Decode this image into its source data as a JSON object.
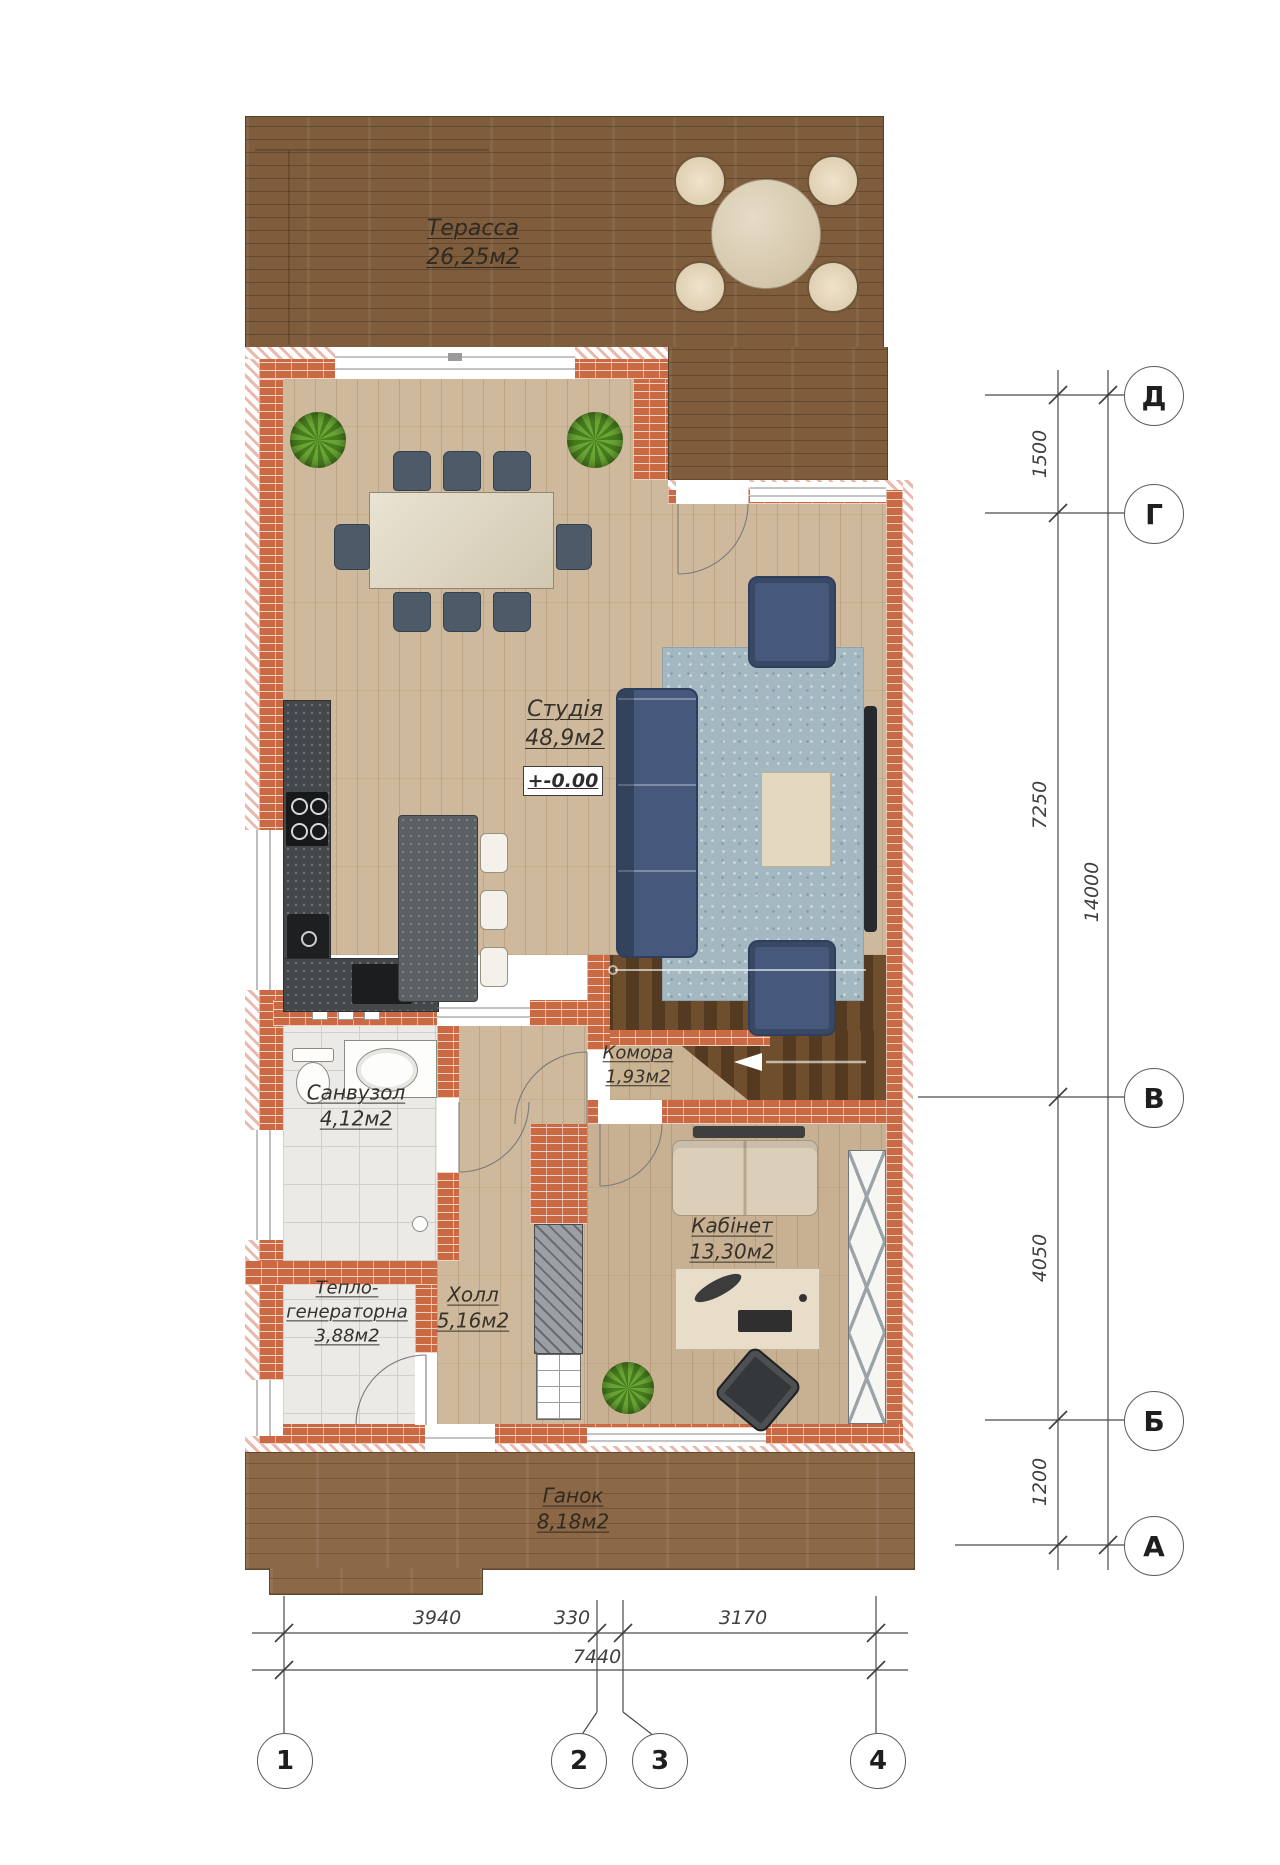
{
  "drawing": {
    "type": "architectural-floor-plan",
    "floor": "first"
  },
  "rooms": {
    "terrace": {
      "name": "Терасса",
      "area": "26,25м2"
    },
    "studio": {
      "name": "Студія",
      "area": "48,9м2"
    },
    "pantry": {
      "name": "Комора",
      "area": "1,93м2"
    },
    "bathroom": {
      "name": "Санвузол",
      "area": "4,12м2"
    },
    "boiler": {
      "name1": "Тепло-",
      "name2": "генераторна",
      "area": "3,88м2"
    },
    "hall": {
      "name": "Холл",
      "area": "5,16м2"
    },
    "office": {
      "name": "Кабінет",
      "area": "13,30м2"
    },
    "porch": {
      "name": "Ганок",
      "area": "8,18м2"
    }
  },
  "elevation": "+-0.00",
  "axes": {
    "rows": [
      "Д",
      "Г",
      "В",
      "Б",
      "А"
    ],
    "cols": [
      "1",
      "2",
      "3",
      "4"
    ]
  },
  "dims": {
    "right": [
      "1500",
      "7250",
      "4050",
      "1200"
    ],
    "right_total": "14000",
    "bottom": [
      "3940",
      "330",
      "3170"
    ],
    "bottom_total": "7440"
  },
  "colors": {
    "brick": "#c96a45",
    "insulation_hatch": "#eab9ae",
    "terrace_wood": "#7e5c3c",
    "porch_wood": "#8c6847",
    "floor_wood": "#cfb99c",
    "stair_wood": "#5e4126",
    "tile": "#eceae6",
    "furniture_blue": "#46597c",
    "rug": "#a8bbc2",
    "annotation_line": "#4a4a4a"
  }
}
